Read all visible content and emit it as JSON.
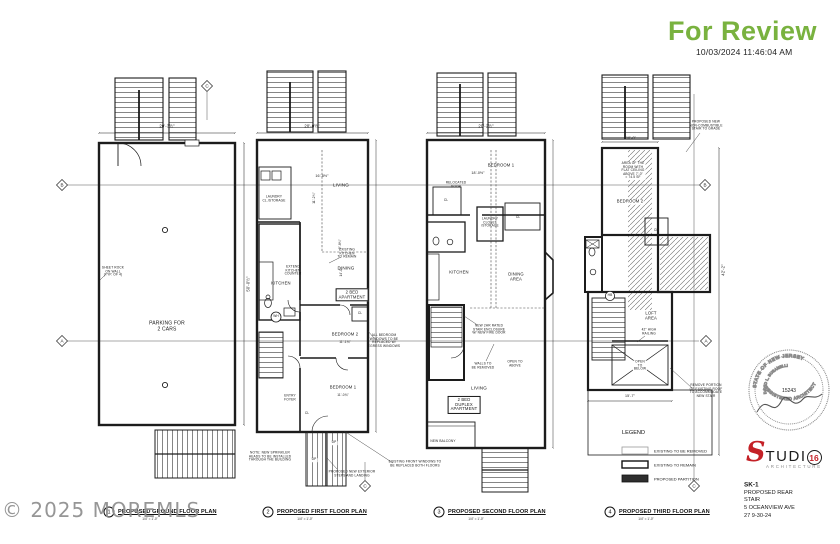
{
  "stamp": {
    "text": "For Review",
    "timestamp": "10/03/2024  11:46:04 AM",
    "color": "#79b23f"
  },
  "watermark": {
    "text": "© 2025 MOREMLS"
  },
  "grid": {
    "bubbles": [
      {
        "letter": "C"
      },
      {
        "letter": "B"
      },
      {
        "letter": "A"
      },
      {
        "letter": "B"
      },
      {
        "letter": "A"
      },
      {
        "letter": "C"
      },
      {
        "letter": "C"
      }
    ]
  },
  "legend": {
    "title": "LEGEND",
    "items": [
      {
        "label": "EXISTING TO BE REMOVED"
      },
      {
        "label": "EXISTING TO REMAIN"
      },
      {
        "label": "PROPOSED PARTITION"
      }
    ]
  },
  "plans": [
    {
      "number": "1",
      "title": "PROPOSED GROUND FLOOR PLAN",
      "scale": "1/4\" = 1'-0\"",
      "labels": {
        "parking": "PARKING FOR\n2 CARS"
      },
      "dims": {
        "top": "20'-3½\"",
        "right": "50'-0½\""
      },
      "notes": {
        "sheetrock": "SHEET ROCK\nON WALL\n(TYP. OF 4)"
      }
    },
    {
      "number": "2",
      "title": "PROPOSED FIRST FLOOR PLAN",
      "scale": "1/4\" = 1'-0\"",
      "labels": {
        "living": "LIVING",
        "dining": "DINING",
        "kitchen": "KITCHEN",
        "laundry": "LAUNDRY\nCL./STORAGE",
        "bedroom2": "BEDROOM 2",
        "bedroom1": "BEDROOM 1",
        "entry": "ENTRY\nFOYER",
        "apartment": "2 BED\nAPARTMENT",
        "wh": "WH",
        "cl1": "CL",
        "cl2": "CL",
        "up1": "UP",
        "up2": "UP"
      },
      "dims": {
        "top": "20'-0½\"",
        "living_w": "16'-8½\"",
        "living_h": "11'-2¾\"",
        "hall": "2'-8¾\"",
        "dining_h": "14'-0\"",
        "bedroom2_w": "11'-1¾\"",
        "bedroom1_w": "11'-0¾\""
      },
      "notes": {
        "kitchen_remain": "EXISTING\nKITCHEN\nTO REMAIN",
        "extend_counter": "EXTEND\nKITCHEN\nCOUNTER",
        "egress": "ALL BEDROOM\nWINDOWS TO BE\nREPLACED W/\nEGRESS WINDOWS",
        "sprinkler": "NOTE: NEW SPRINKLER\nHEADS TO BE INSTALLED\nTHROUGH THE BUILDING",
        "steps": "PROPOSED NEW EXTERIOR\nSTEPS AND LANDING",
        "front_windows": "EXISTING FRONT WINDOWS TO\nBE REPLACED BOTH FLOORS"
      }
    },
    {
      "number": "3",
      "title": "PROPOSED SECOND FLOOR PLAN",
      "scale": "1/4\" = 1'-0\"",
      "labels": {
        "bedroom1": "BEDROOM 1",
        "cl1": "CL",
        "cl2": "CL",
        "laundry": "LAUNDRY\nCLOSET\n/STORAGE",
        "kitchen": "KITCHEN",
        "dining": "DINING\nAREA",
        "living": "LIVING",
        "apartment": "2 BED\nDUPLEX\nAPARTMENT",
        "balcony": "NEW BALCONY"
      },
      "dims": {
        "top": "20'-2½\"",
        "bedroom_w": "18'-0½\""
      },
      "notes": {
        "relocated_door": "RELOCATED\nDOOR",
        "stair_enclosure": "NEW 2HR RATED\nSTAIR ENCLOSURE\nW/ NEW FIRE DOOR",
        "walls_removed": "WALLS TO\nBE REMOVED",
        "open_above": "OPEN TO\nABOVE"
      }
    },
    {
      "number": "4",
      "title": "PROPOSED THIRD FLOOR PLAN",
      "scale": "1/4\" = 1'-0\"",
      "labels": {
        "bedroom2": "BEDROOM 2",
        "cl": "CL",
        "loft": "LOFT\nAREA",
        "open_below": "OPEN\nTO\nBELOW",
        "hb": "HB"
      },
      "dims": {
        "top": "10'-0\"",
        "bottom": "15'-7\"",
        "right": "42'-2\""
      },
      "notes": {
        "flat_ceiling": "AREA OF THE\nROOM WITH\nFLAT CEILING\nABOVE 7'-0\"\n= 74.5 SF",
        "railing": "42\" HIGH\nRAILING",
        "new_stair": "PROPOSED NEW\nNON-COMBUSTIBLE\nSTAIR TO GRADE",
        "remove_roof": "REMOVE PORTION\nOF EXISTING ROOF\nTO ACCOMMODATE\nNEW STAIR"
      }
    }
  ],
  "seal": {
    "arc_top": "STATE OF NEW JERSEY",
    "name": "DAVID L. BUSANELLI",
    "number": "15243",
    "arc_bottom": "REGISTERED ARCHITECT"
  },
  "logo": {
    "s": "S",
    "rest": "TUDI",
    "o_number": "16",
    "tagline": "ARCHITECTURE",
    "red": "#c42127"
  },
  "title_block": {
    "sheet": "SK-1",
    "line1": "PROPOSED REAR",
    "line2": "STAIR",
    "line3": "5 OCEANVIEW AVE",
    "line4": "27    9-30-24"
  }
}
